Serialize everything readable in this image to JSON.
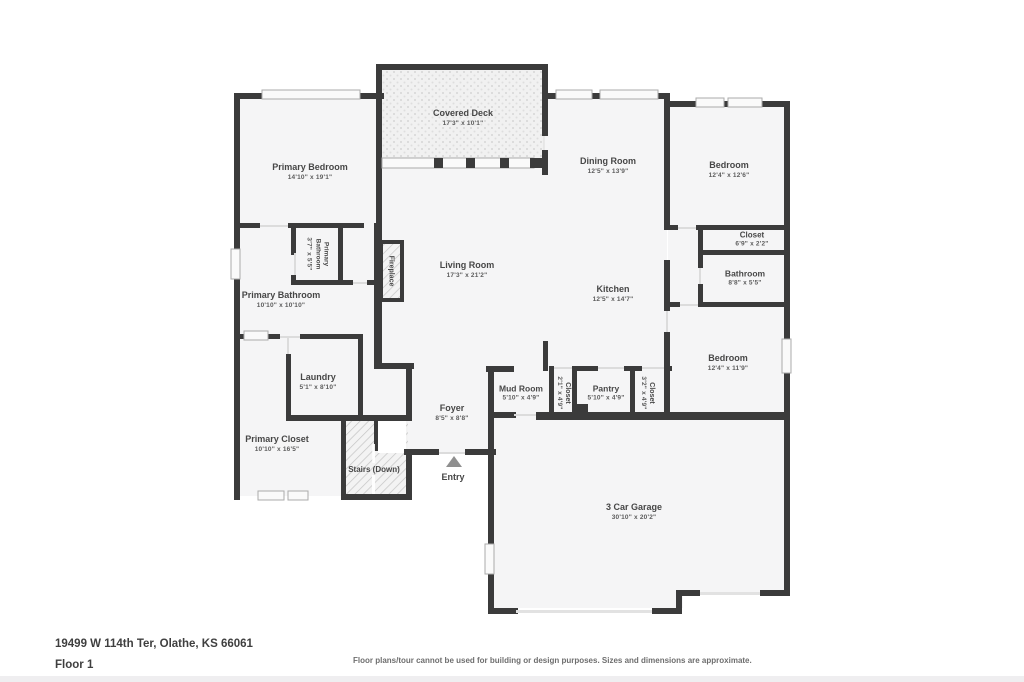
{
  "page": {
    "background": "#ffffff"
  },
  "colors": {
    "wall": "#3b3b3b",
    "room_fill": "#f5f5f6",
    "deck_fill": "#f1f1f1",
    "hatch_line": "#c4c4c4",
    "window_fill": "#fafafa",
    "window_border": "#ababab",
    "door_line": "#dcdcdc",
    "label_text": "#474747",
    "dim_text": "#5c5c5c"
  },
  "rooms": [
    {
      "id": "covered-deck",
      "name": "Covered Deck",
      "dims": "17'3\" x 10'1\""
    },
    {
      "id": "primary-bedroom",
      "name": "Primary Bedroom",
      "dims": "14'10\" x 19'1\""
    },
    {
      "id": "dining-room",
      "name": "Dining Room",
      "dims": "12'5\" x 13'9\""
    },
    {
      "id": "bedroom-1",
      "name": "Bedroom",
      "dims": "12'4\" x 12'6\""
    },
    {
      "id": "living-room",
      "name": "Living Room",
      "dims": "17'3\" x 21'2\""
    },
    {
      "id": "kitchen",
      "name": "Kitchen",
      "dims": "12'5\" x 14'7\""
    },
    {
      "id": "fireplace",
      "name": "Fireplace",
      "dims": ""
    },
    {
      "id": "primary-bathroom-small",
      "name": "Primary Bathroom",
      "dims": "3'7\" x 5'5\""
    },
    {
      "id": "primary-bathroom",
      "name": "Primary Bathroom",
      "dims": "10'10\" x 10'10\""
    },
    {
      "id": "closet-1",
      "name": "Closet",
      "dims": "6'9\" x 2'2\""
    },
    {
      "id": "bathroom",
      "name": "Bathroom",
      "dims": "8'8\" x 5'5\""
    },
    {
      "id": "bedroom-2",
      "name": "Bedroom",
      "dims": "12'4\" x 11'9\""
    },
    {
      "id": "laundry",
      "name": "Laundry",
      "dims": "5'1\" x 8'10\""
    },
    {
      "id": "mud-room",
      "name": "Mud Room",
      "dims": "5'10\" x 4'9\""
    },
    {
      "id": "closet-2",
      "name": "Closet",
      "dims": "2'1\" x 4'9\""
    },
    {
      "id": "pantry",
      "name": "Pantry",
      "dims": "5'10\" x 4'9\""
    },
    {
      "id": "closet-3",
      "name": "Closet",
      "dims": "3'2\" x 4'9\""
    },
    {
      "id": "foyer",
      "name": "Foyer",
      "dims": "8'5\" x 8'8\""
    },
    {
      "id": "primary-closet",
      "name": "Primary Closet",
      "dims": "10'10\" x 16'5\""
    },
    {
      "id": "stairs",
      "name": "Stairs (Down)",
      "dims": ""
    },
    {
      "id": "entry",
      "name": "Entry",
      "dims": ""
    },
    {
      "id": "garage",
      "name": "3 Car Garage",
      "dims": "30'10\" x 20'2\""
    }
  ],
  "entry_marker": {
    "icon": "triangle-up"
  },
  "footer": {
    "address": "19499 W 114th Ter, Olathe, KS 66061",
    "floor_label": "Floor 1",
    "disclaimer": "Floor plans/tour cannot be used for building or design purposes. Sizes and dimensions are approximate."
  }
}
